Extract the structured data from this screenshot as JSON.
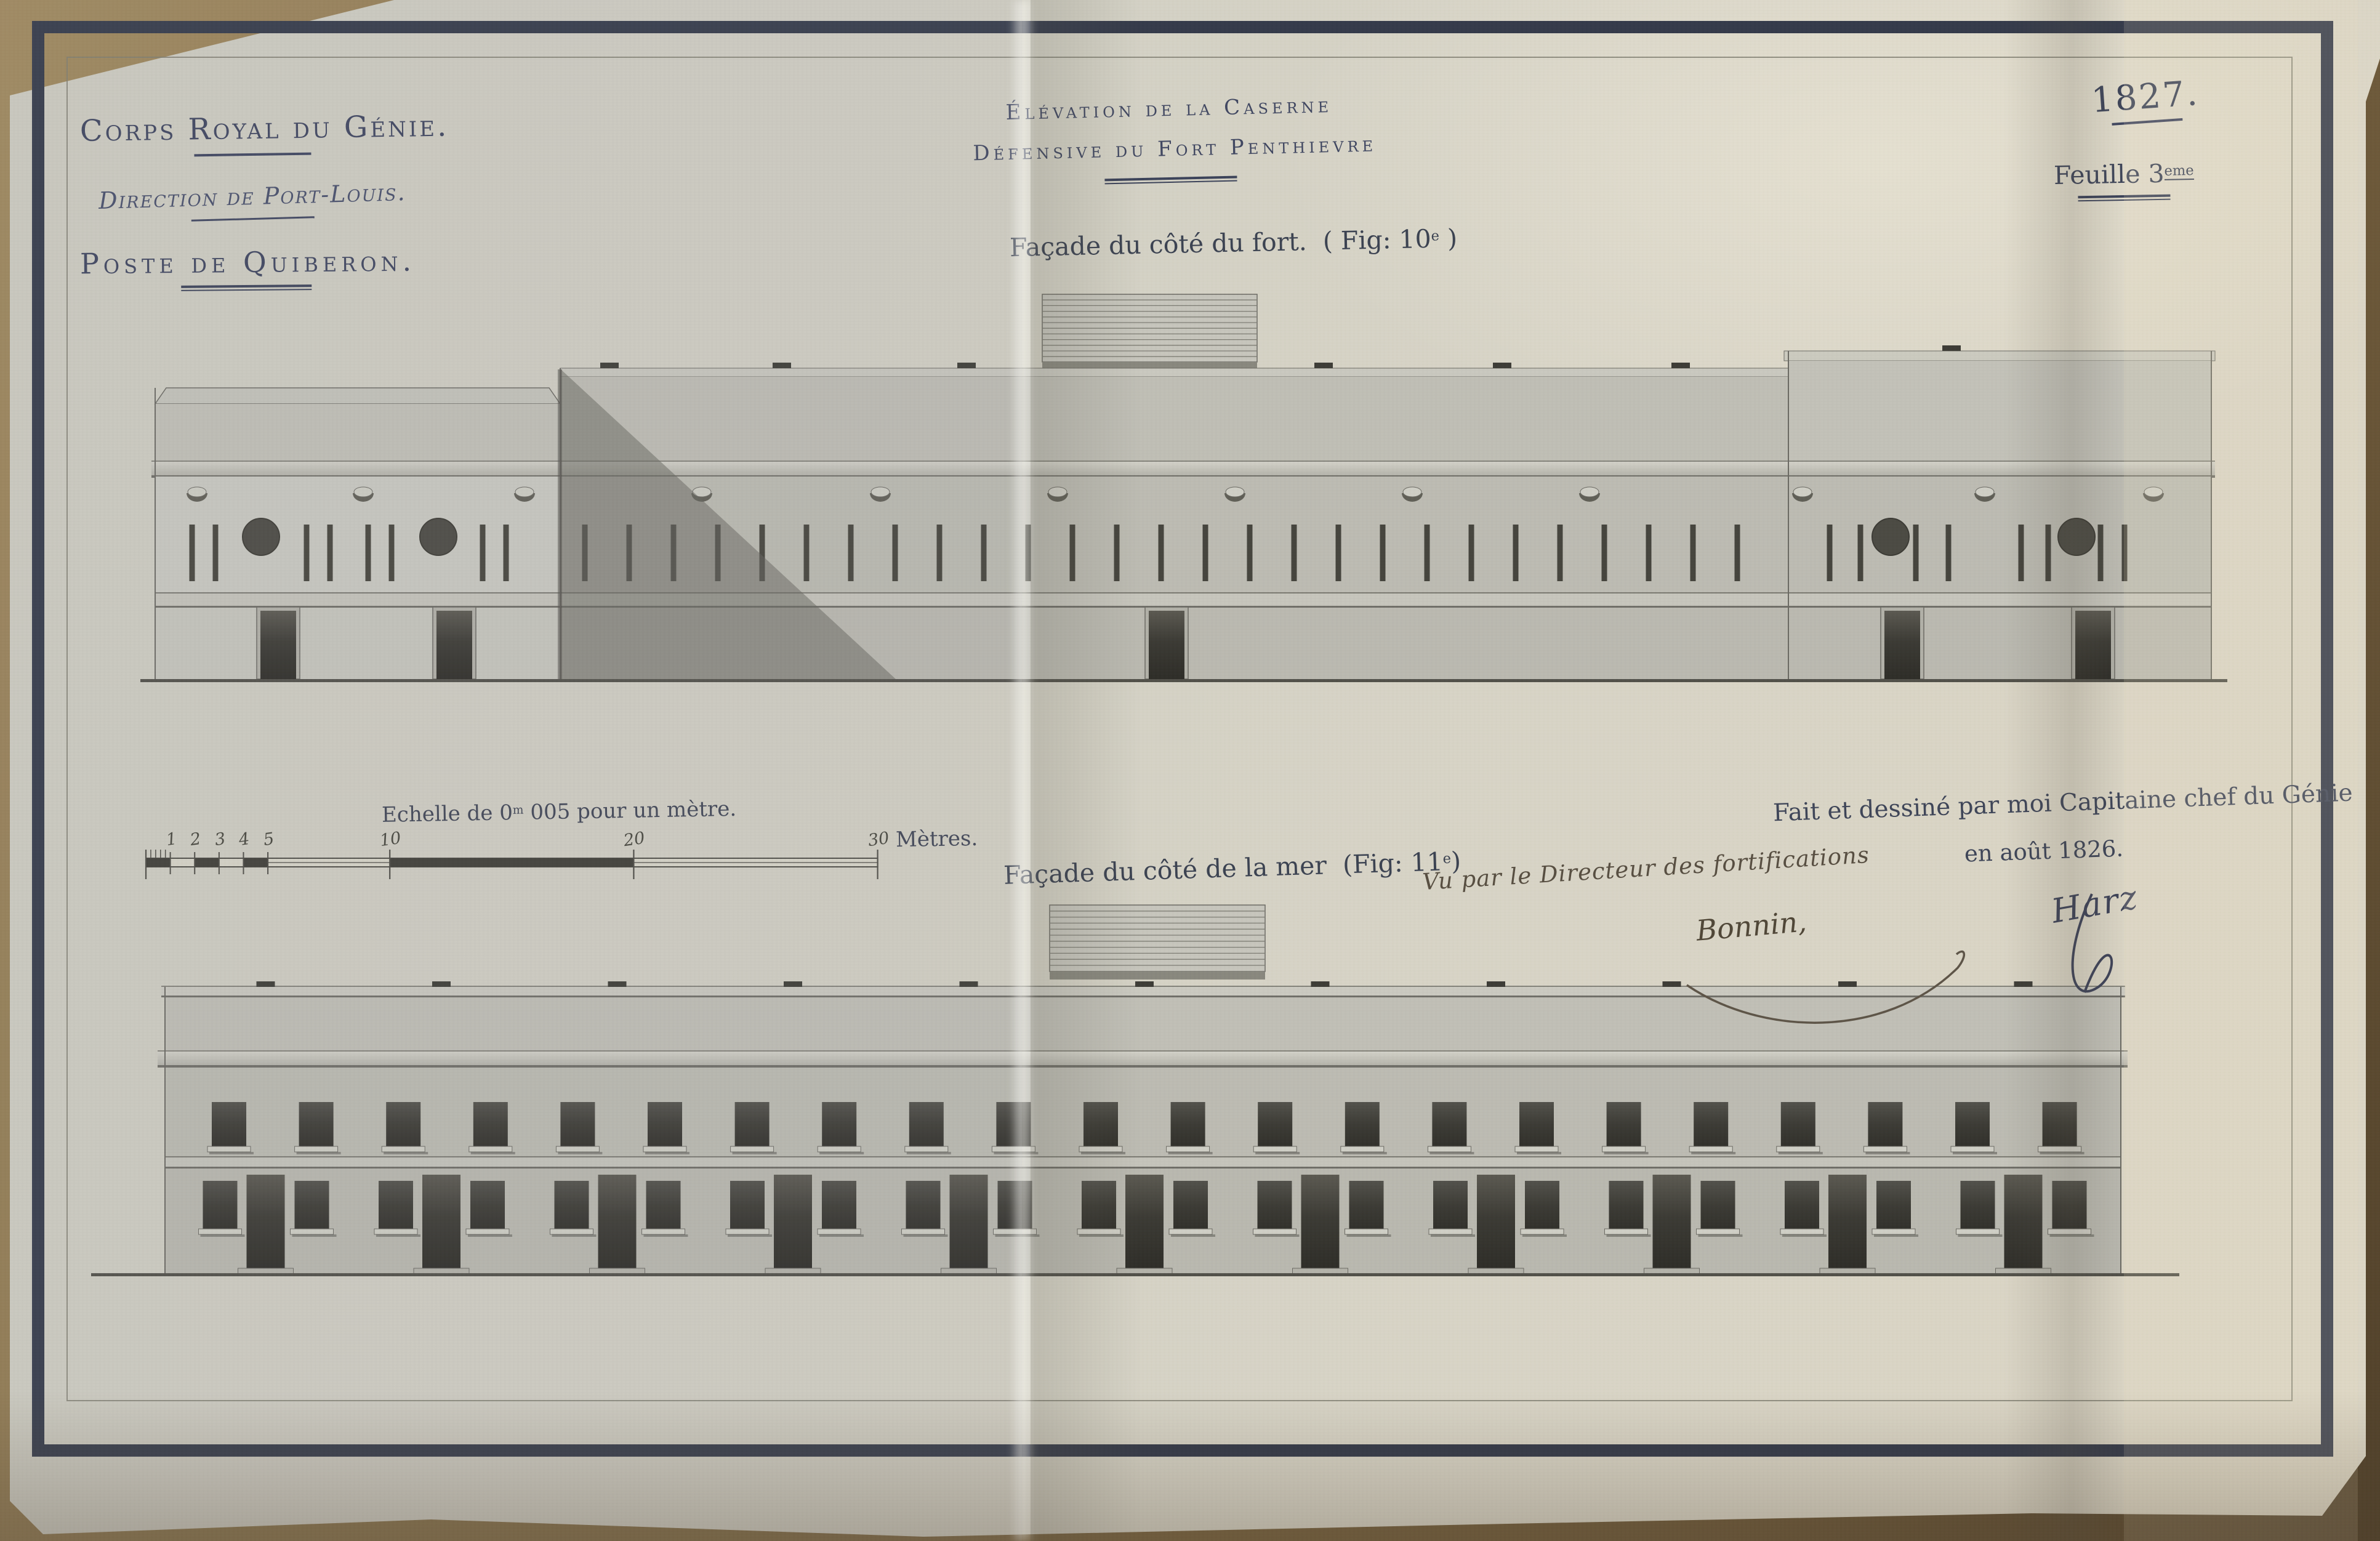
{
  "document": {
    "year": "1827.",
    "sheet": {
      "label": "Feuille 3",
      "sup": "eme"
    },
    "header": {
      "corps": "Corps Royal du Génie.",
      "direction": "Direction de Port-Louis.",
      "poste": "Poste de Quiberon."
    },
    "title": {
      "line1": "Élévation de la Caserne",
      "line2": "Défensive du Fort Penthievre"
    },
    "figures": {
      "fig10": {
        "caption": "Façade du côté du fort.",
        "fig_open": "( Fig: 10",
        "fig_sup": "e",
        "fig_close": " )"
      },
      "fig11": {
        "caption": "Façade du côté de la mer",
        "fig_open": "(Fig: 11",
        "fig_sup": "e",
        "fig_close": ")"
      }
    },
    "scale": {
      "label_pre": "Echelle de 0",
      "label_sup": "m",
      "label_post": " 005 pour un mètre.",
      "unit": "Mètres.",
      "ticks": [
        1,
        2,
        3,
        4,
        5,
        10,
        20,
        30
      ]
    },
    "annotations": {
      "visa": "Vu par le Directeur des fortifications",
      "visa_signature": "Bonnin,",
      "made_line1": "Fait et dessiné par moi Capitaine chef du Génie",
      "made_line2": "en août 1826.",
      "made_signature": "Harz"
    }
  }
}
